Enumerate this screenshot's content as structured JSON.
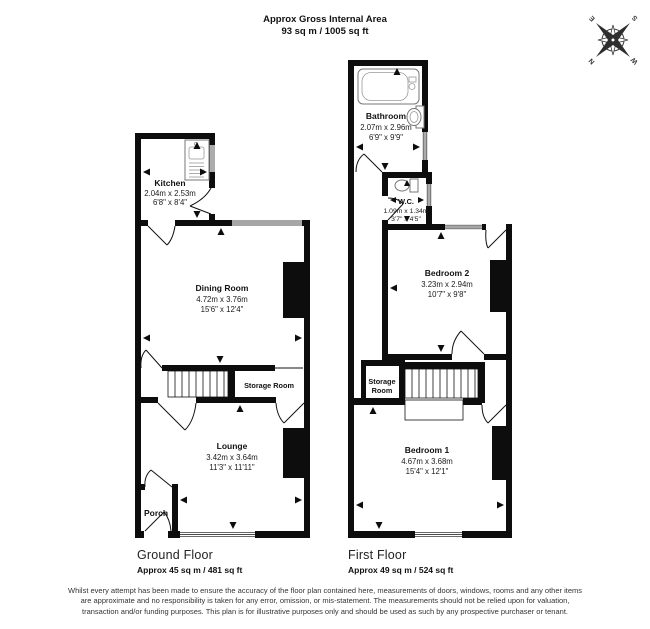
{
  "header": {
    "title": "Approx Gross Internal Area",
    "subtitle": "93 sq m / 1005 sq ft"
  },
  "compass": {
    "n": "N",
    "e": "E",
    "s": "S",
    "w": "W"
  },
  "ground_floor": {
    "label": "Ground Floor",
    "area": "Approx 45 sq m / 481 sq ft",
    "rooms": {
      "kitchen": {
        "name": "Kitchen",
        "metric": "2.04m x 2.53m",
        "imperial": "6'8\" x 8'4\""
      },
      "dining": {
        "name": "Dining Room",
        "metric": "4.72m x 3.76m",
        "imperial": "15'6\" x 12'4\""
      },
      "storage": {
        "name": "Storage Room"
      },
      "lounge": {
        "name": "Lounge",
        "metric": "3.42m x 3.64m",
        "imperial": "11'3\" x 11'11\""
      },
      "porch": {
        "name": "Porch"
      }
    }
  },
  "first_floor": {
    "label": "First Floor",
    "area": "Approx 49 sq m / 524 sq ft",
    "rooms": {
      "bathroom": {
        "name": "Bathroom",
        "metric": "2.07m x 2.96m",
        "imperial": "6'9\" x 9'9\""
      },
      "wc": {
        "name": "W.C.",
        "metric": "1.09m x 1.34m",
        "imperial": "3'7\" x 4'5\""
      },
      "bedroom2": {
        "name": "Bedroom 2",
        "metric": "3.23m x 2.94m",
        "imperial": "10'7\" x 9'8\""
      },
      "storage": {
        "line1": "Storage",
        "line2": "Room"
      },
      "bedroom1": {
        "name": "Bedroom 1",
        "metric": "4.67m x 3.68m",
        "imperial": "15'4\" x 12'1\""
      }
    }
  },
  "disclaimer": "Whilst every attempt has been made to ensure the accuracy of the floor plan contained here, measurements of doors, windows, rooms and any other items are approximate and no responsibility is taken for any error, omission, or mis-statement. The measurements should not be relied upon for valuation, transaction and/or funding purposes. This plan is for illustrative purposes only and should be used as such by any prospective purchaser or tenant."
}
